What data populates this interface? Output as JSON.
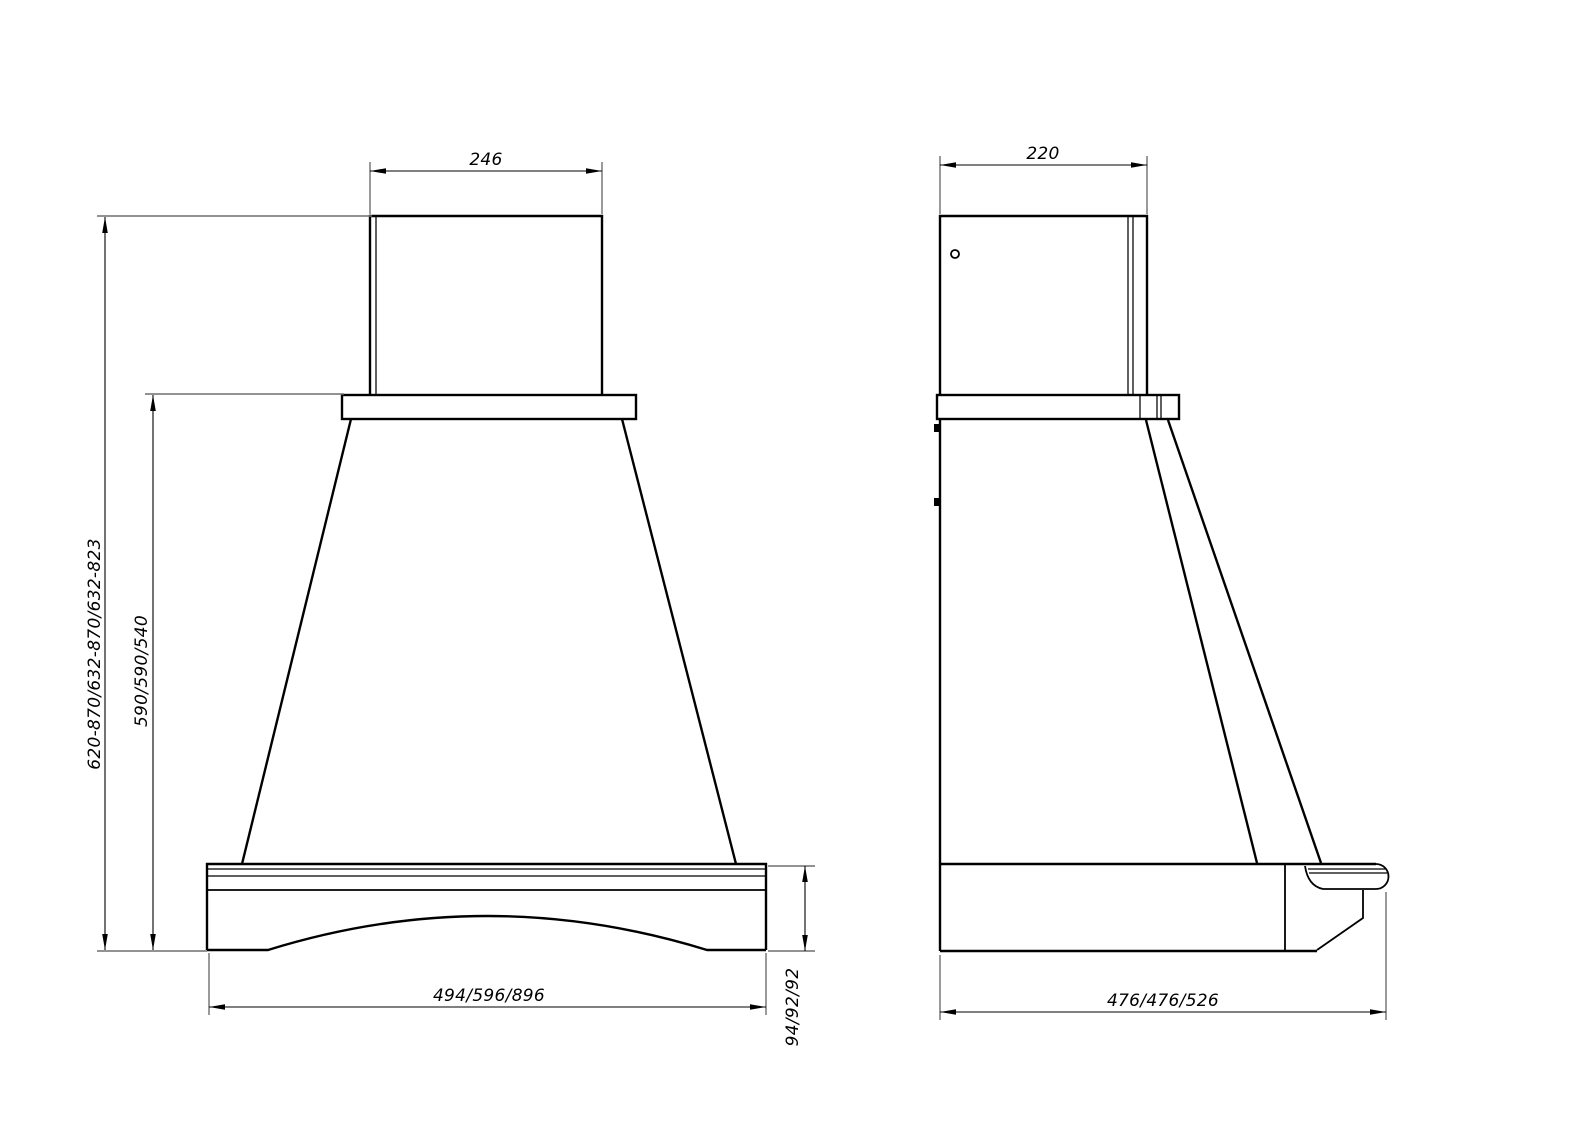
{
  "front_view": {
    "dims": {
      "chimney_width": "246",
      "overall_height_range": "620-870/632-870/632-823",
      "body_height": "590/590/540",
      "base_width": "494/596/896",
      "base_trim_height": "94/92/92"
    }
  },
  "side_view": {
    "dims": {
      "chimney_depth": "220",
      "base_depth": "476/476/526"
    }
  },
  "style": {
    "line_color": "#000000",
    "extension_line_color": "#6e6e6e",
    "background_color": "#ffffff"
  }
}
